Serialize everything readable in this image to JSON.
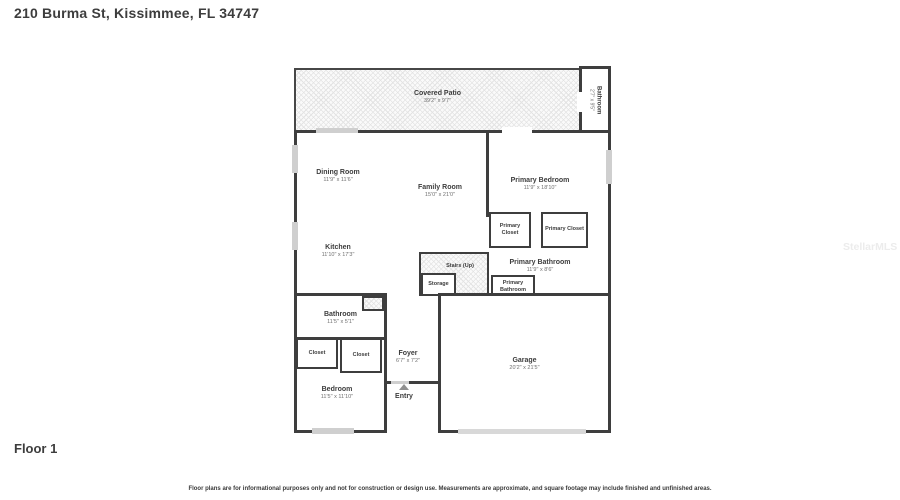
{
  "page": {
    "title": "210 Burma St, Kissimmee, FL 34747",
    "floor_label": "Floor 1",
    "watermark": "StellarMLS",
    "disclaimer": "Floor plans are for informational purposes only and not for construction or design use. Measurements are approximate, and square footage may include finished and unfinished areas."
  },
  "rooms": {
    "covered_patio": {
      "name": "Covered Patio",
      "dims": "39'2\" x 9'7\""
    },
    "upper_bathroom": {
      "name": "Bathroom",
      "dims": "2'7\" x 9'5\""
    },
    "dining_room": {
      "name": "Dining Room",
      "dims": "11'9\" x 11'6\""
    },
    "family_room": {
      "name": "Family Room",
      "dims": "15'0\" x 21'0\""
    },
    "primary_bedroom": {
      "name": "Primary Bedroom",
      "dims": "11'9\" x 18'10\""
    },
    "primary_closet_left": {
      "name": "Primary Closet"
    },
    "primary_closet_right": {
      "name": "Primary Closet"
    },
    "kitchen": {
      "name": "Kitchen",
      "dims": "11'10\" x 17'3\""
    },
    "stairs": {
      "name": "Stairs (Up)"
    },
    "storage": {
      "name": "Storage"
    },
    "primary_bathroom": {
      "name": "Primary Bathroom",
      "dims": "11'9\" x 8'6\""
    },
    "primary_bathroom_wc": {
      "name": "Primary Bathroom"
    },
    "bathroom": {
      "name": "Bathroom",
      "dims": "11'5\" x 5'1\""
    },
    "closet_left": {
      "name": "Closet"
    },
    "closet_right": {
      "name": "Closet"
    },
    "foyer": {
      "name": "Foyer",
      "dims": "6'7\" x 7'2\""
    },
    "bedroom": {
      "name": "Bedroom",
      "dims": "11'5\" x 11'10\""
    },
    "garage": {
      "name": "Garage",
      "dims": "20'2\" x 21'5\""
    },
    "entry": {
      "name": "Entry"
    }
  }
}
